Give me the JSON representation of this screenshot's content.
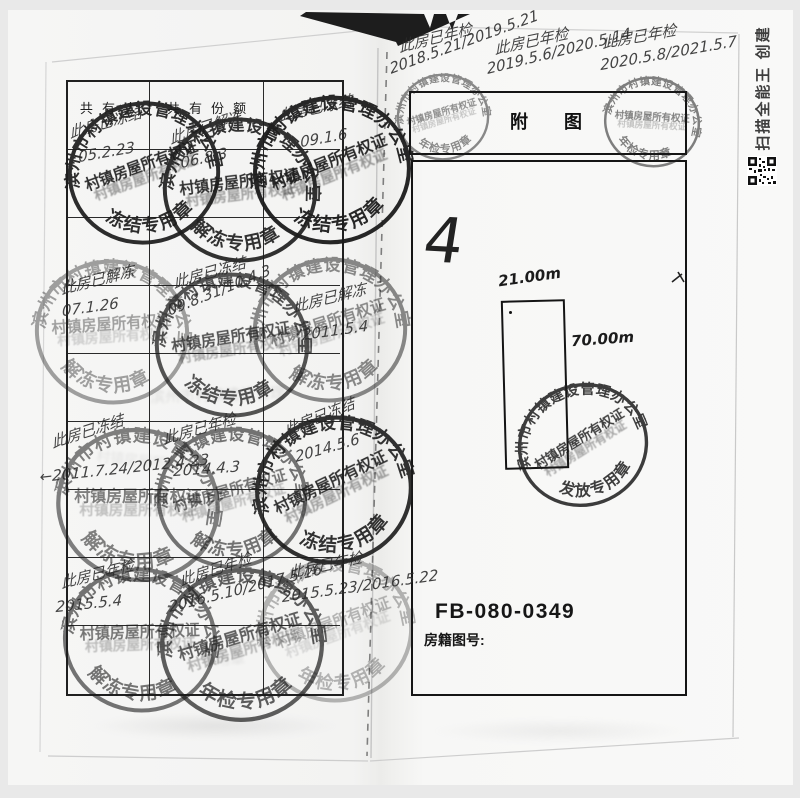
{
  "watermark": {
    "text": "扫描全能王 创建"
  },
  "left_page": {
    "table_headers": {
      "col1": "共有人",
      "col2": "共有份额",
      "col3": ""
    },
    "stamps": [
      {
        "x": 144,
        "y": 173,
        "rx": 86,
        "ry": 79,
        "rot": -8,
        "op": 0.92,
        "outer": "滨州市村镇建设管理办公室",
        "mid": "村镇房屋所有权证",
        "bot": "冻结专用章"
      },
      {
        "x": 240,
        "y": 190,
        "rx": 88,
        "ry": 80,
        "rot": 5,
        "op": 0.9,
        "outer": "滨州市村镇建设管理办公室",
        "mid": "村镇房屋所有权证",
        "bot": "解冻专用章"
      },
      {
        "x": 332,
        "y": 170,
        "rx": 85,
        "ry": 82,
        "rot": -10,
        "op": 0.95,
        "outer": "滨州市村镇建设管理办公室",
        "mid": "村镇房屋所有权证",
        "bot": "冻结专用章"
      },
      {
        "x": 112,
        "y": 332,
        "rx": 82,
        "ry": 80,
        "rot": 8,
        "op": 0.4,
        "outer": "滨州市村镇建设管理办公室",
        "mid": "村镇房屋所有权证",
        "bot": "解冻专用章"
      },
      {
        "x": 232,
        "y": 345,
        "rx": 80,
        "ry": 83,
        "rot": 3,
        "op": 0.75,
        "outer": "滨州市村镇建设管理办公室",
        "mid": "村镇房屋所有权证",
        "bot": "冻结专用章"
      },
      {
        "x": 330,
        "y": 330,
        "rx": 85,
        "ry": 80,
        "rot": -6,
        "op": 0.5,
        "outer": "滨州市村镇建设管理办公室",
        "mid": "村镇房屋所有权证",
        "bot": "解冻专用章"
      },
      {
        "x": 138,
        "y": 505,
        "rx": 85,
        "ry": 88,
        "rot": 12,
        "op": 0.55,
        "outer": "滨州市村镇建设管理办公室",
        "mid": "村镇房屋所有权证",
        "bot": "解冻专用章"
      },
      {
        "x": 232,
        "y": 498,
        "rx": 78,
        "ry": 85,
        "rot": -4,
        "op": 0.6,
        "outer": "滨州市村镇建设管理办公室",
        "mid": "村镇房屋所有权证",
        "bot": "解冻专用章"
      },
      {
        "x": 334,
        "y": 490,
        "rx": 85,
        "ry": 82,
        "rot": -14,
        "op": 0.9,
        "outer": "滨州市村镇建设管理办公室",
        "mid": "村镇房屋所有权证",
        "bot": "冻结专用章"
      },
      {
        "x": 140,
        "y": 640,
        "rx": 80,
        "ry": 82,
        "rot": 10,
        "op": 0.6,
        "outer": "滨州市村镇建设管理办公室",
        "mid": "村镇房屋所有权证",
        "bot": "解冻专用章"
      },
      {
        "x": 242,
        "y": 645,
        "rx": 85,
        "ry": 85,
        "rot": -5,
        "op": 0.7,
        "outer": "滨州市村镇建设管理办公室",
        "mid": "村镇房屋所有权证",
        "bot": "年检专用章"
      },
      {
        "x": 336,
        "y": 630,
        "rx": 80,
        "ry": 80,
        "rot": -8,
        "op": 0.3,
        "outer": "滨州市村镇建设管理办公室",
        "mid": "村镇房屋所有权证",
        "bot": "年检专用章"
      }
    ],
    "notes": [
      {
        "t": "此房已冻结",
        "x": 68,
        "y": 122,
        "r": -16
      },
      {
        "t": "05.2.23",
        "x": 78,
        "y": 148,
        "r": -10
      },
      {
        "t": "此房已解冻",
        "x": 168,
        "y": 128,
        "r": -18
      },
      {
        "t": "06.8.3",
        "x": 180,
        "y": 154,
        "r": -12
      },
      {
        "t": "此房已冻结",
        "x": 278,
        "y": 105,
        "r": -12
      },
      {
        "t": "09.1.6",
        "x": 300,
        "y": 133,
        "r": -10
      },
      {
        "t": "此房已解冻",
        "x": 60,
        "y": 278,
        "r": -14
      },
      {
        "t": "07.1.26",
        "x": 62,
        "y": 302,
        "r": -8
      },
      {
        "t": "此房已冻结",
        "x": 172,
        "y": 272,
        "r": -16
      },
      {
        "t": "09.8.31/10.4.3",
        "x": 166,
        "y": 302,
        "r": -22
      },
      {
        "t": "此房已解冻",
        "x": 292,
        "y": 296,
        "r": -14
      },
      {
        "t": "2011.5.4",
        "x": 302,
        "y": 326,
        "r": -8
      },
      {
        "t": "此房已冻结",
        "x": 50,
        "y": 432,
        "r": -18
      },
      {
        "t": "←2011.7.24/2012.4.23",
        "x": 40,
        "y": 468,
        "r": -6
      },
      {
        "t": "此房已年检",
        "x": 162,
        "y": 428,
        "r": -16
      },
      {
        "t": "2014.4.3",
        "x": 174,
        "y": 462,
        "r": -4
      },
      {
        "t": "此房已冻结",
        "x": 282,
        "y": 420,
        "r": -22
      },
      {
        "t": "2014.5.6",
        "x": 294,
        "y": 448,
        "r": -16
      },
      {
        "t": "此房已年检",
        "x": 60,
        "y": 572,
        "r": -14
      },
      {
        "t": "2015.5.4",
        "x": 56,
        "y": 598,
        "r": -6
      },
      {
        "t": "此房已年检",
        "x": 178,
        "y": 570,
        "r": -18
      },
      {
        "t": "2016.5.10/2017.5.16",
        "x": 168,
        "y": 598,
        "r": -14
      },
      {
        "t": "此房已年检",
        "x": 288,
        "y": 562,
        "r": -12
      },
      {
        "t": "2015.5.23/2016.5.22",
        "x": 282,
        "y": 588,
        "r": -8
      }
    ]
  },
  "right_page": {
    "title": "附　　图",
    "plan": {
      "number_mark": "4",
      "width_label": "21.00m",
      "height_label": "70.00m"
    },
    "doc_code": "FB-080-0349",
    "doc_code_label": "房籍图号:",
    "stamps": [
      {
        "x": 443,
        "y": 117,
        "rx": 55,
        "ry": 48,
        "rot": -5,
        "op": 0.5,
        "outer": "滨州市村镇建设管理办公室",
        "mid": "村镇房屋所有权证",
        "bot": "年检专用章"
      },
      {
        "x": 652,
        "y": 122,
        "rx": 58,
        "ry": 50,
        "rot": 15,
        "op": 0.55,
        "outer": "滨州市村镇建设管理办公室",
        "mid": "村镇房屋所有权证",
        "bot": "年检专用章"
      },
      {
        "x": 583,
        "y": 445,
        "rx": 68,
        "ry": 76,
        "rot": -20,
        "op": 0.85,
        "outer": "滨州市村镇建设管理办公室",
        "mid": "村镇房屋所有权证",
        "bot": "发放专用章"
      }
    ],
    "notes": [
      {
        "t": "此房已年检",
        "x": 398,
        "y": 36,
        "r": -14
      },
      {
        "t": "2018.5.21/2019.5.21",
        "x": 388,
        "y": 60,
        "r": -20
      },
      {
        "t": "此房已年检",
        "x": 494,
        "y": 38,
        "r": -12
      },
      {
        "t": "2019.5.6/2020.5.14",
        "x": 486,
        "y": 60,
        "r": -14
      },
      {
        "t": "此房已年检",
        "x": 602,
        "y": 32,
        "r": -10
      },
      {
        "t": "2020.5.8/2021.5.7",
        "x": 600,
        "y": 56,
        "r": -10
      }
    ]
  }
}
